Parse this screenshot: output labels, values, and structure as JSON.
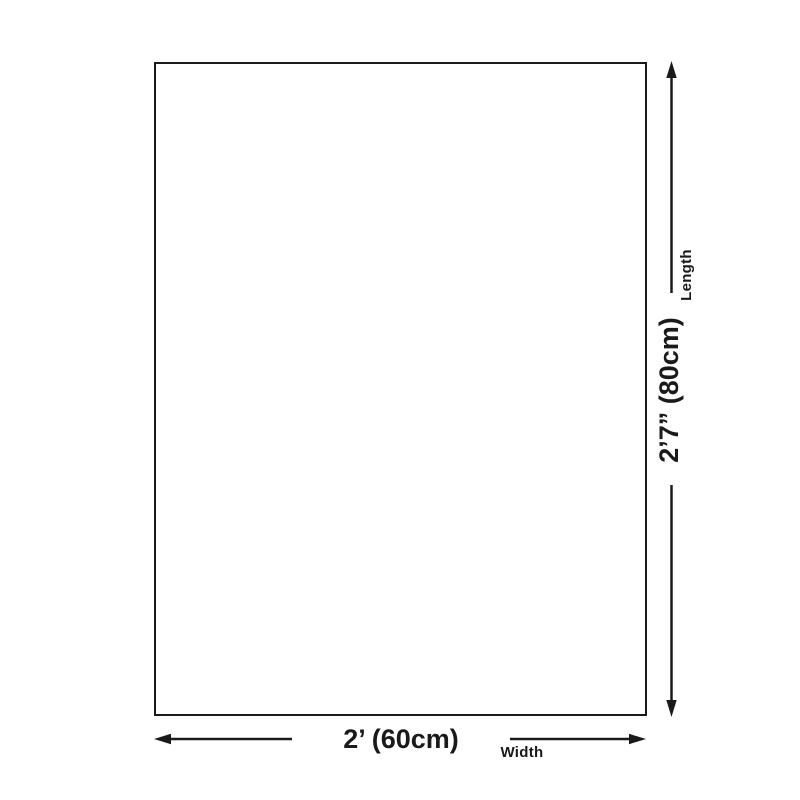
{
  "page": {
    "background_color": "#ffffff"
  },
  "diagram": {
    "kind": "product-dimension-diagram",
    "line_color": "#1a1a1a",
    "rectangle_fill": "#ffffff",
    "length_dimension": {
      "label": "Length",
      "value": "2’7” (80cm)"
    },
    "width_dimension": {
      "label": "Width",
      "value": "2’ (60cm)"
    }
  }
}
